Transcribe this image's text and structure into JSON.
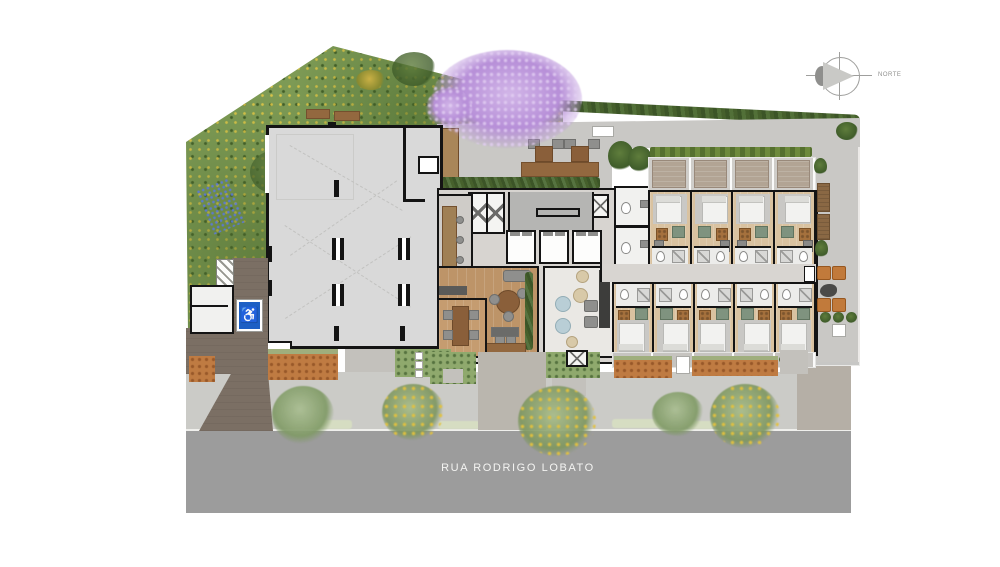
{
  "street": {
    "label": "RUA RODRIGO LOBATO"
  },
  "compass": {
    "label": "NORTE"
  },
  "accessible_parking": {
    "symbol": "♿",
    "color": "#1d5fc4"
  },
  "building": {
    "elevators": 3,
    "units_top_row": 4,
    "units_bottom_row": 5,
    "common_toilets": 2
  },
  "landscape": {
    "sidewalk_trees": 5,
    "flowering_tree_color": "#b790d6",
    "garden_color": "#7d9a55"
  },
  "colors": {
    "street": "#9c9c9c",
    "sidewalk": "#cbcbc7",
    "paving": "#c9c8c5",
    "hall_floor": "#d9d9d9",
    "core_floor": "#d7d4d0",
    "walls": "#141414",
    "lobby_wood": "#bd9468",
    "unit_wood": "#d9c2a0",
    "hedge": "#46602c",
    "driveway": "#7b6f64",
    "accent_orange": "#c07a3e"
  }
}
